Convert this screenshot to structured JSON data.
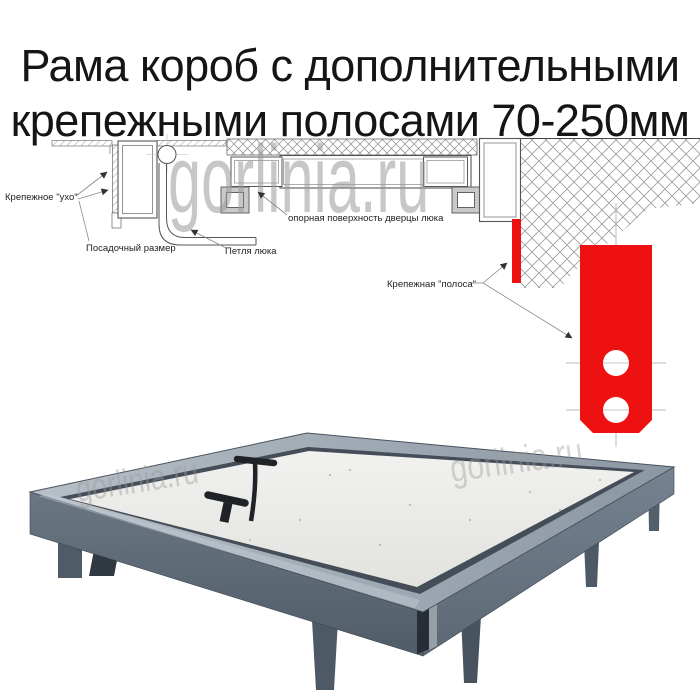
{
  "title": {
    "line1": "Рама короб с дополнительными",
    "line2": "крепежными полосами 70-250мм"
  },
  "watermark": {
    "text": "gorlinia.ru"
  },
  "diagram": {
    "labels": {
      "ear": "Крепежное \"ухо\"",
      "seat": "Посадочный размер",
      "hinge": "Петля люка",
      "support": "опорная поверхность дверцы люка",
      "strip": "Крепежная \"полоса\""
    },
    "colors": {
      "red": "#ee1111",
      "line": "#555555"
    }
  },
  "photo": {
    "colors": {
      "steel": "#66727e",
      "rim": "#a9b3bd",
      "panel": "#e9e9e7",
      "handle": "#1f2328"
    }
  }
}
